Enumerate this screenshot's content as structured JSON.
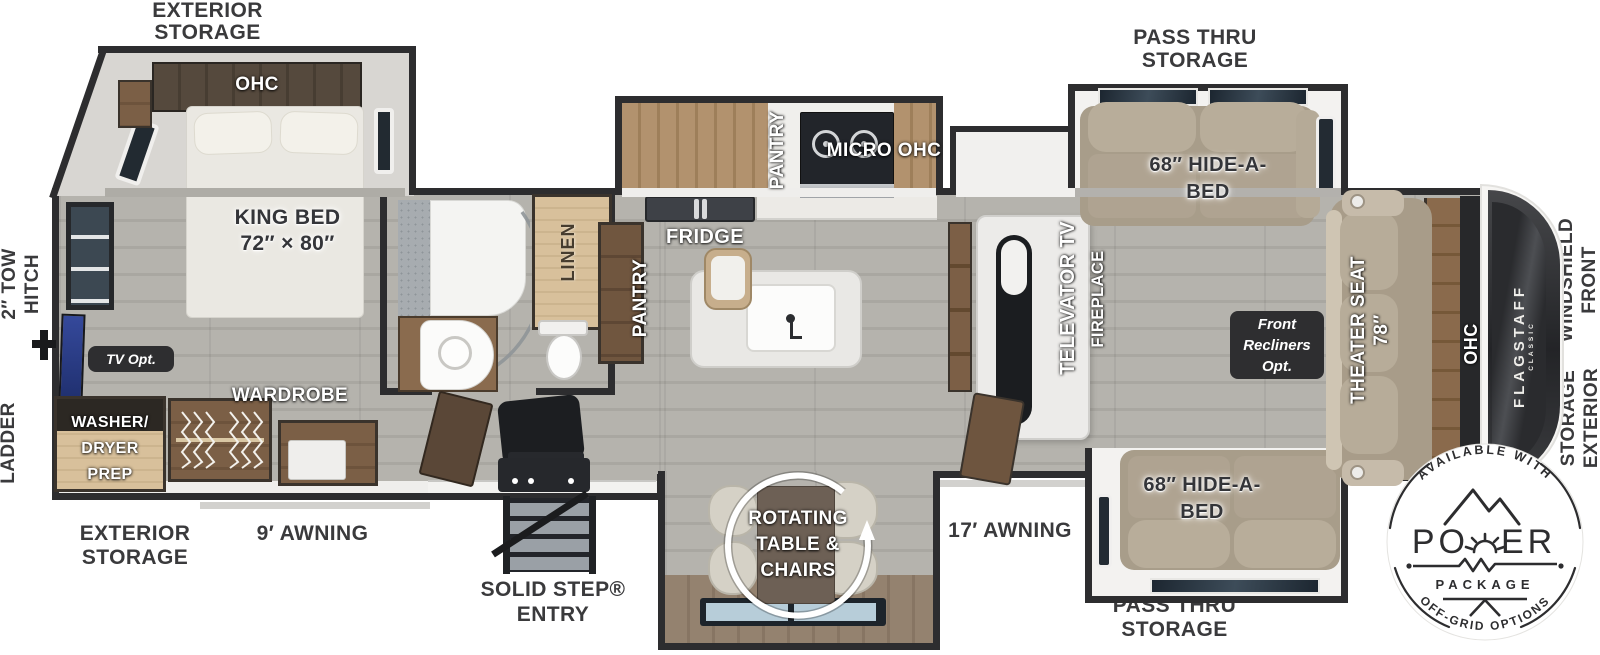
{
  "outside": {
    "exterior_storage_top": [
      "EXTERIOR",
      "STORAGE"
    ],
    "pass_thru_top": [
      "PASS THRU",
      "STORAGE"
    ],
    "pass_thru_bottom": [
      "PASS THRU",
      "STORAGE"
    ],
    "exterior_storage_bottom": [
      "EXTERIOR",
      "STORAGE"
    ],
    "awning_rear": "9′ AWNING",
    "awning_main": "17′ AWNING",
    "solid_step": [
      "SOLID STEP®",
      "ENTRY"
    ],
    "tow_hitch": [
      "2″ TOW",
      "HITCH"
    ],
    "ladder": "LADDER",
    "front_windshield": [
      "FRONT",
      "WINDSHIELD"
    ],
    "exterior_storage_front": [
      "EXTERIOR",
      "STORAGE"
    ]
  },
  "bedroom": {
    "ohc": "OHC",
    "king_bed": [
      "KING BED",
      "72″ × 80″"
    ],
    "tv_opt": "TV Opt.",
    "washer_dryer": [
      "WASHER/",
      "DRYER",
      "PREP"
    ],
    "wardrobe": "WARDROBE"
  },
  "bathroom": {
    "linen": "LINEN"
  },
  "kitchen": {
    "pantry_slide": "PANTRY",
    "pantry_cabinet": "PANTRY",
    "fridge": "FRIDGE",
    "micro_ohc": "MICRO OHC"
  },
  "living": {
    "televator": "TELEVATOR TV",
    "fireplace": "FIREPLACE",
    "hide_a_bed_top": [
      "68″ HIDE-A-",
      "BED"
    ],
    "hide_a_bed_bottom": [
      "68″ HIDE-A-",
      "BED"
    ],
    "recliners_opt": [
      "Front",
      "Recliners",
      "Opt."
    ],
    "theater_seat": "THEATER SEAT",
    "theater_size": "78″",
    "ohc": "OHC",
    "dinette": [
      "ROTATING",
      "TABLE &",
      "CHAIRS"
    ]
  },
  "brand": {
    "name": "FLAGSTAFF",
    "sub": "CLASSIC"
  },
  "power_badge": {
    "top": "AVAILABLE WITH",
    "word_left": "PO",
    "word_right": "ER",
    "package": "PACKAGE",
    "bottom": "OFF-GRID OPTIONS"
  }
}
